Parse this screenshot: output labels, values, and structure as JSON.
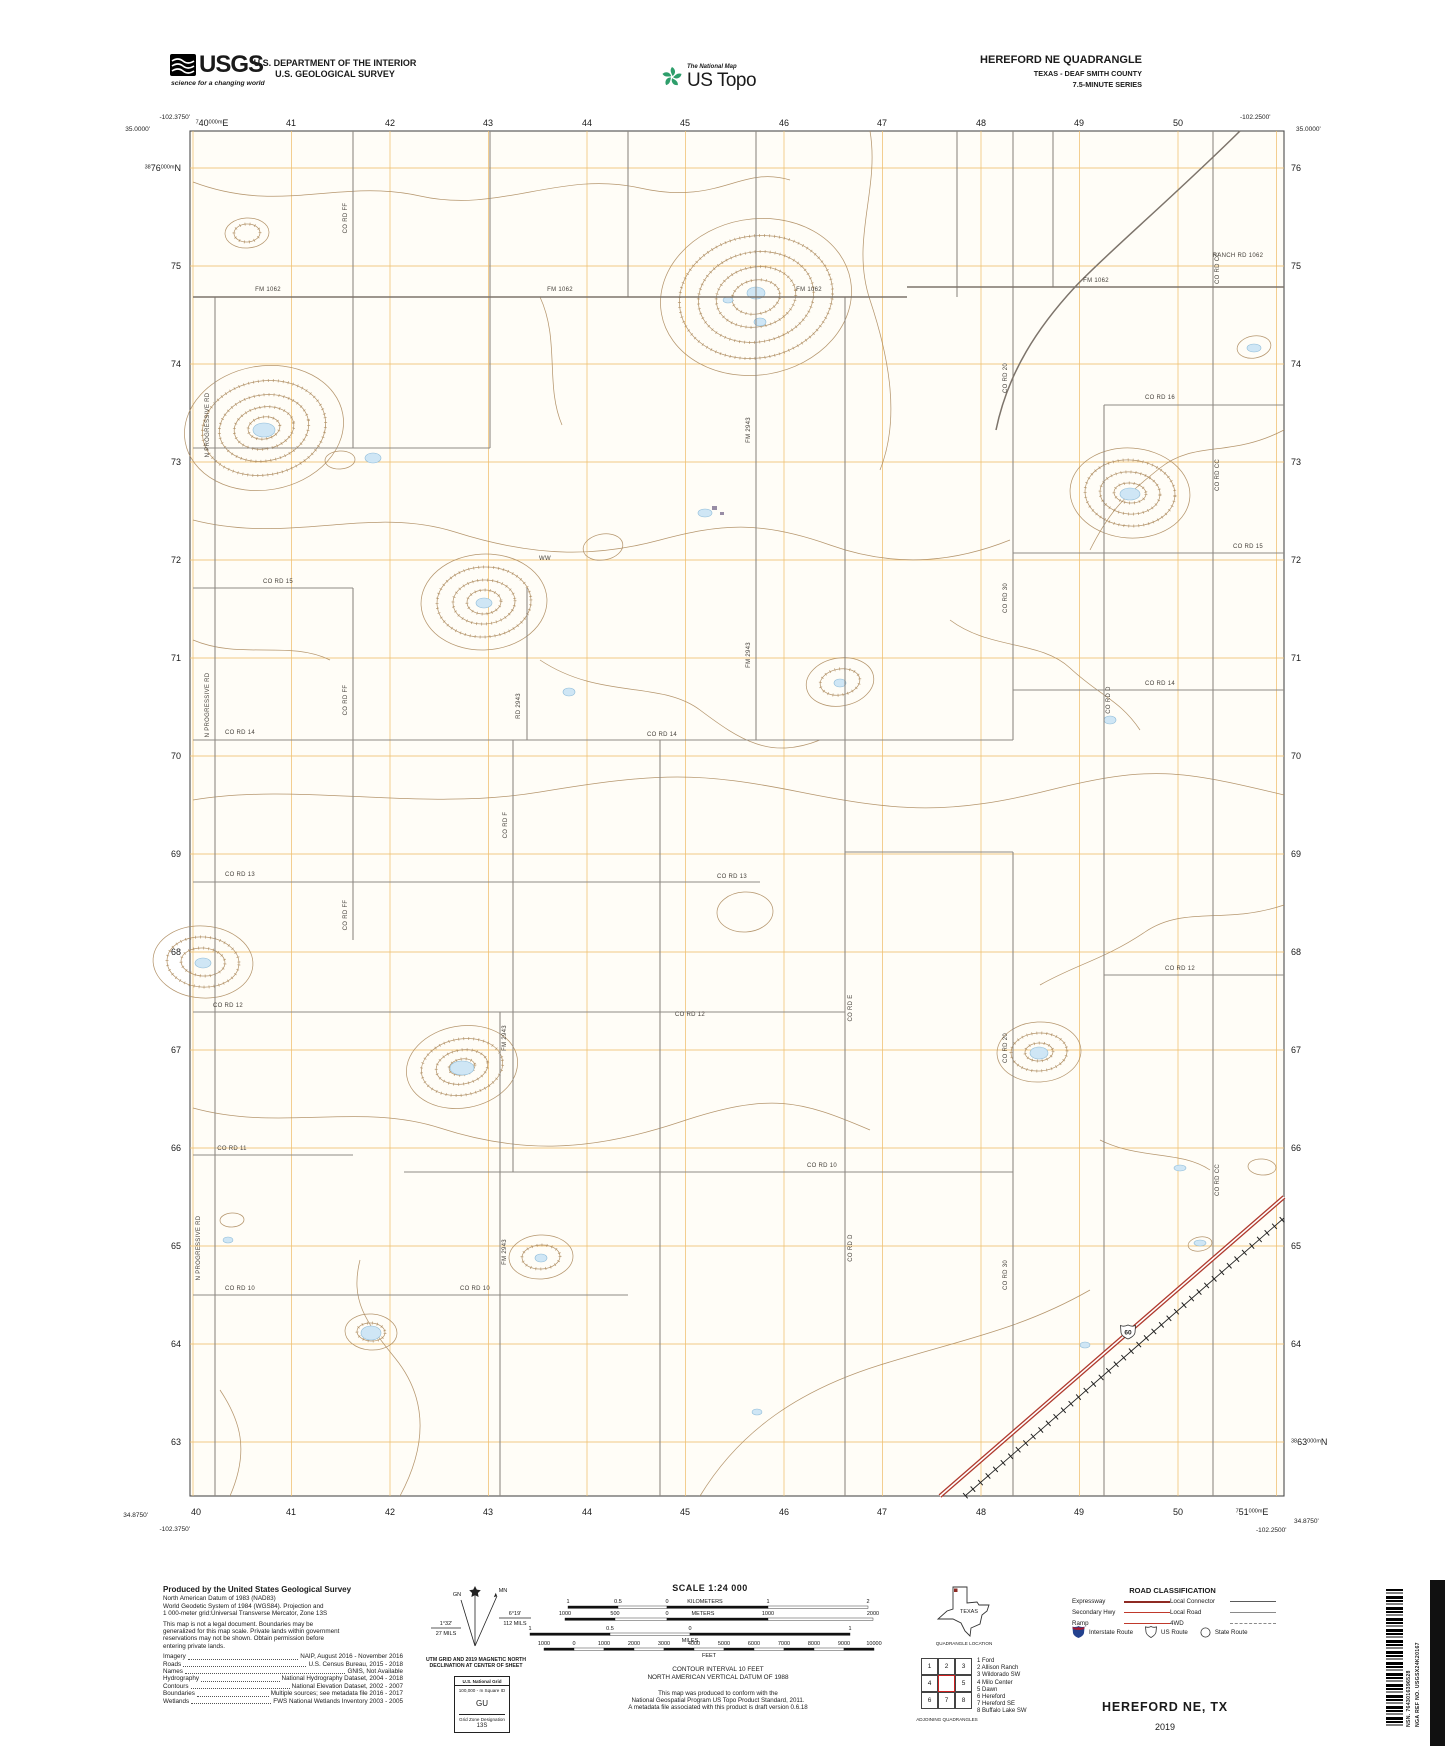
{
  "header": {
    "usgs_logo_text": "USGS",
    "usgs_tagline": "science for a changing world",
    "dept1": "U.S. DEPARTMENT OF THE INTERIOR",
    "dept2": "U.S. GEOLOGICAL SURVEY",
    "tnm": "The National Map",
    "ustopo": "US Topo",
    "quad1": "HEREFORD NE QUADRANGLE",
    "quad2": "TEXAS - DEAF SMITH COUNTY",
    "quad3": "7.5-MINUTE SERIES"
  },
  "map": {
    "corners": {
      "tl_lon": "-102.3750'",
      "tl_lat": "35.0000'",
      "tr_lon": "-102.2500'",
      "tr_lat": "35.0000'",
      "bl_lat": "34.8750'",
      "bl_lon": "-102.3750'",
      "br_lon": "-102.2500'",
      "br_lat": "34.8750'"
    },
    "shield_number": "60",
    "grid_top": [
      {
        "p": [
          [
            "7",
            true
          ],
          [
            "40",
            false
          ],
          [
            "000m",
            true
          ],
          [
            "E",
            false
          ]
        ],
        "x": 212
      },
      {
        "t": "41",
        "x": 291
      },
      {
        "t": "42",
        "x": 390
      },
      {
        "t": "43",
        "x": 488
      },
      {
        "t": "44",
        "x": 587
      },
      {
        "t": "45",
        "x": 685
      },
      {
        "t": "46",
        "x": 784
      },
      {
        "t": "47",
        "x": 882
      },
      {
        "t": "48",
        "x": 981
      },
      {
        "t": "49",
        "x": 1079
      },
      {
        "t": "50",
        "x": 1178
      }
    ],
    "grid_bottom": [
      {
        "t": "40",
        "x": 196
      },
      {
        "t": "41",
        "x": 291
      },
      {
        "t": "42",
        "x": 390
      },
      {
        "t": "43",
        "x": 488
      },
      {
        "t": "44",
        "x": 587
      },
      {
        "t": "45",
        "x": 685
      },
      {
        "t": "46",
        "x": 784
      },
      {
        "t": "47",
        "x": 882
      },
      {
        "t": "48",
        "x": 981
      },
      {
        "t": "49",
        "x": 1079
      },
      {
        "t": "50",
        "x": 1178
      },
      {
        "p": [
          [
            "7",
            true
          ],
          [
            "51",
            false
          ],
          [
            "000m",
            true
          ],
          [
            "E",
            false
          ]
        ],
        "x": 1252
      }
    ],
    "grid_left": [
      {
        "p": [
          [
            "38",
            true
          ],
          [
            "76",
            false
          ],
          [
            "000m",
            true
          ],
          [
            "N",
            false
          ]
        ],
        "y": 168
      },
      {
        "t": "75",
        "y": 266
      },
      {
        "t": "74",
        "y": 364
      },
      {
        "t": "73",
        "y": 462
      },
      {
        "t": "72",
        "y": 560
      },
      {
        "t": "71",
        "y": 658
      },
      {
        "t": "70",
        "y": 756
      },
      {
        "t": "69",
        "y": 854
      },
      {
        "t": "68",
        "y": 952
      },
      {
        "t": "67",
        "y": 1050
      },
      {
        "t": "66",
        "y": 1148
      },
      {
        "t": "65",
        "y": 1246
      },
      {
        "t": "64",
        "y": 1344
      },
      {
        "t": "63",
        "y": 1442
      }
    ],
    "grid_right": [
      {
        "t": "76",
        "y": 168
      },
      {
        "t": "75",
        "y": 266
      },
      {
        "t": "74",
        "y": 364
      },
      {
        "t": "73",
        "y": 462
      },
      {
        "t": "72",
        "y": 560
      },
      {
        "t": "71",
        "y": 658
      },
      {
        "t": "70",
        "y": 756
      },
      {
        "t": "69",
        "y": 854
      },
      {
        "t": "68",
        "y": 952
      },
      {
        "t": "67",
        "y": 1050
      },
      {
        "t": "66",
        "y": 1148
      },
      {
        "t": "65",
        "y": 1246
      },
      {
        "t": "64",
        "y": 1344
      },
      {
        "p": [
          [
            "38",
            true
          ],
          [
            "63",
            false
          ],
          [
            "000m",
            true
          ],
          [
            "N",
            false
          ]
        ],
        "y": 1442
      }
    ],
    "road_labels": [
      {
        "t": "CO RD FF",
        "x": 347,
        "y": 218,
        "r": -90
      },
      {
        "t": "FM 1062",
        "x": 268,
        "y": 291,
        "r": 0
      },
      {
        "t": "FM 1062",
        "x": 560,
        "y": 291,
        "r": 0
      },
      {
        "t": "FM 1062",
        "x": 809,
        "y": 291,
        "r": 0
      },
      {
        "t": "FM 1062",
        "x": 1096,
        "y": 282,
        "r": 0
      },
      {
        "t": "RANCH RD 1062",
        "x": 1238,
        "y": 257,
        "r": 0
      },
      {
        "t": "CO RD CC",
        "x": 1219,
        "y": 268,
        "r": -90
      },
      {
        "t": "CO RD 20",
        "x": 1007,
        "y": 378,
        "r": -90
      },
      {
        "t": "CO RD 16",
        "x": 1160,
        "y": 399,
        "r": 0
      },
      {
        "t": "N PROGRESSIVE RD",
        "x": 209,
        "y": 425,
        "r": -90
      },
      {
        "t": "FM 2943",
        "x": 750,
        "y": 430,
        "r": -90
      },
      {
        "t": "CO RD CC",
        "x": 1219,
        "y": 475,
        "r": -90
      },
      {
        "t": "CO RD 15",
        "x": 1248,
        "y": 548,
        "r": 0
      },
      {
        "t": "CO RD 15",
        "x": 278,
        "y": 583,
        "r": 0
      },
      {
        "t": "WW",
        "x": 545,
        "y": 560,
        "r": 0
      },
      {
        "t": "CO RD 30",
        "x": 1007,
        "y": 598,
        "r": -90
      },
      {
        "t": "FM 2943",
        "x": 750,
        "y": 655,
        "r": -90
      },
      {
        "t": "CO RD 14",
        "x": 1160,
        "y": 685,
        "r": 0
      },
      {
        "t": "CO RD 14",
        "x": 240,
        "y": 734,
        "r": 0
      },
      {
        "t": "CO RD 14",
        "x": 662,
        "y": 736,
        "r": 0
      },
      {
        "t": "N PROGRESSIVE RD",
        "x": 209,
        "y": 705,
        "r": -90
      },
      {
        "t": "CO RD FF",
        "x": 347,
        "y": 700,
        "r": -90
      },
      {
        "t": "RD 2943",
        "x": 520,
        "y": 706,
        "r": -90
      },
      {
        "t": "CO RD D",
        "x": 1110,
        "y": 700,
        "r": -90
      },
      {
        "t": "CO RD F",
        "x": 507,
        "y": 825,
        "r": -90
      },
      {
        "t": "CO RD 13",
        "x": 240,
        "y": 876,
        "r": 0
      },
      {
        "t": "CO RD 13",
        "x": 732,
        "y": 878,
        "r": 0
      },
      {
        "t": "CO RD FF",
        "x": 347,
        "y": 915,
        "r": -90
      },
      {
        "t": "CO RD 12",
        "x": 1180,
        "y": 970,
        "r": 0
      },
      {
        "t": "CO RD E",
        "x": 852,
        "y": 1008,
        "r": -90
      },
      {
        "t": "CO RD 12",
        "x": 228,
        "y": 1007,
        "r": 0
      },
      {
        "t": "CO RD 12",
        "x": 690,
        "y": 1016,
        "r": 0
      },
      {
        "t": "CO RD 20",
        "x": 1007,
        "y": 1048,
        "r": -90
      },
      {
        "t": "FM 2943",
        "x": 506,
        "y": 1038,
        "r": -90
      },
      {
        "t": "CO RD 11",
        "x": 232,
        "y": 1150,
        "r": 0
      },
      {
        "t": "CO RD CC",
        "x": 1219,
        "y": 1180,
        "r": -90
      },
      {
        "t": "CO RD 10",
        "x": 822,
        "y": 1167,
        "r": 0
      },
      {
        "t": "CO RD D",
        "x": 852,
        "y": 1248,
        "r": -90
      },
      {
        "t": "CO RD 30",
        "x": 1007,
        "y": 1275,
        "r": -90
      },
      {
        "t": "FM 2943",
        "x": 506,
        "y": 1252,
        "r": -90
      },
      {
        "t": "N PROGRESSIVE RD",
        "x": 200,
        "y": 1248,
        "r": -90
      },
      {
        "t": "CO RD 10",
        "x": 240,
        "y": 1290,
        "r": 0
      },
      {
        "t": "CO RD 10",
        "x": 475,
        "y": 1290,
        "r": 0
      }
    ]
  },
  "footer": {
    "credits": {
      "title": "Produced by the United States Geological Survey",
      "datum_lines": [
        "North American Datum of 1983 (NAD83)",
        "World Geodetic System of 1984 (WGS84).  Projection and",
        "1 000-meter grid:Universal Transverse Mercator, Zone 13S"
      ],
      "legal_lines": [
        "This map is not a legal document. Boundaries may be",
        "generalized for this map scale. Private lands within government",
        "reservations may not be shown. Obtain permission before",
        "entering private lands."
      ],
      "sources": [
        {
          "k": "Imagery",
          "v": "NAIP, August 2016 - November 2016"
        },
        {
          "k": "Roads",
          "v": "U.S. Census Bureau, 2015 - 2018"
        },
        {
          "k": "Names",
          "v": "GNIS, Not Available"
        },
        {
          "k": "Hydrography",
          "v": "National Hydrography Dataset, 2004 - 2018"
        },
        {
          "k": "Contours",
          "v": "National Elevation Dataset, 2002 - 2007"
        },
        {
          "k": "Boundaries",
          "v": "Multiple sources; see metadata file 2016 - 2017"
        },
        {
          "k": "Wetlands",
          "v": "FWS National Wetlands Inventory 2003 - 2005"
        }
      ]
    },
    "declination": {
      "mn": "MN",
      "gn": "GN",
      "left_deg": "1°32'",
      "left_mils": "27 MILS",
      "right_deg": "6°19'",
      "right_mils": "112 MILS",
      "caption1": "UTM GRID AND 2019 MAGNETIC NORTH",
      "caption2": "DECLINATION AT CENTER OF SHEET"
    },
    "usng": {
      "title": "U.S. National Grid",
      "sub": "100,000 - m Square ID",
      "square": "GU",
      "zone_label": "Grid Zone Designation",
      "zone": "13S"
    },
    "scale": {
      "title": "SCALE 1:24 000",
      "bars": [
        {
          "unit": "KILOMETERS",
          "unit_x": 215,
          "unit_inline": true,
          "ticks": [
            {
              "t": "1",
              "x": 78
            },
            {
              "t": "0.5",
              "x": 128
            },
            {
              "t": "0",
              "x": 177
            },
            {
              "t": "1",
              "x": 278
            },
            {
              "t": "2",
              "x": 378
            }
          ]
        },
        {
          "unit": "METERS",
          "unit_x": 213,
          "unit_inline": true,
          "ticks": [
            {
              "t": "1000",
              "x": 75
            },
            {
              "t": "500",
              "x": 125
            },
            {
              "t": "0",
              "x": 177
            },
            {
              "t": "1000",
              "x": 278
            },
            {
              "t": "2000",
              "x": 383
            }
          ]
        },
        {
          "unit": "MILES",
          "unit_x": 200,
          "unit_inline": false,
          "ticks": [
            {
              "t": "1",
              "x": 40
            },
            {
              "t": "0.5",
              "x": 120
            },
            {
              "t": "0",
              "x": 200
            },
            {
              "t": "1",
              "x": 360
            }
          ]
        },
        {
          "unit": "FEET",
          "unit_x": 219,
          "unit_inline": false,
          "ticks": [
            {
              "t": "1000",
              "x": 54
            },
            {
              "t": "0",
              "x": 84
            },
            {
              "t": "1000",
              "x": 114
            },
            {
              "t": "2000",
              "x": 144
            },
            {
              "t": "3000",
              "x": 174
            },
            {
              "t": "4000",
              "x": 204
            },
            {
              "t": "5000",
              "x": 234
            },
            {
              "t": "6000",
              "x": 264
            },
            {
              "t": "7000",
              "x": 294
            },
            {
              "t": "8000",
              "x": 324
            },
            {
              "t": "9000",
              "x": 354
            },
            {
              "t": "10000",
              "x": 384
            }
          ]
        }
      ],
      "contour1": "CONTOUR INTERVAL 10 FEET",
      "contour2": "NORTH AMERICAN VERTICAL DATUM OF 1988",
      "conform": [
        "This map was produced to conform with the",
        "National Geospatial Program US Topo Product Standard, 2011.",
        "A metadata file associated with this product is draft version 0.6.18"
      ]
    },
    "location": {
      "state": "TEXAS",
      "caption": "QUADRANGLE LOCATION"
    },
    "adjoining": {
      "cells": [
        "1",
        "2",
        "3",
        "4",
        "",
        "5",
        "6",
        "7",
        "8"
      ],
      "caption": "ADJOINING QUADRANGLES",
      "list": [
        {
          "n": "1",
          "name": "Ford"
        },
        {
          "n": "2",
          "name": "Allison Ranch"
        },
        {
          "n": "3",
          "name": "Wildorado SW"
        },
        {
          "n": "4",
          "name": "Milo Center"
        },
        {
          "n": "5",
          "name": "Dawn"
        },
        {
          "n": "6",
          "name": "Hereford"
        },
        {
          "n": "7",
          "name": "Hereford SE"
        },
        {
          "n": "8",
          "name": "Buffalo Lake SW"
        }
      ]
    },
    "roadclass": {
      "title": "ROAD CLASSIFICATION",
      "expressway": "Expressway",
      "secondary": "Secondary Hwy",
      "ramp": "Ramp",
      "local_connector": "Local Connector",
      "local_road": "Local Road",
      "fwd": "4WD",
      "interstate": "Interstate Route",
      "us_route": "US Route",
      "state_route": "State Route"
    },
    "title": {
      "name": "HEREFORD NE,  TX",
      "year": "2019"
    },
    "barcode": {
      "nsn": "NSN.  7643016396528",
      "nga": "NGA REF NO.  USGSX24K20167"
    }
  },
  "colors": {
    "grid": "#f0c070",
    "contour": "#ad8b5e",
    "water_fill": "#cfe6f5",
    "road": "#8f8a84",
    "expressway": "#b03a2e"
  }
}
